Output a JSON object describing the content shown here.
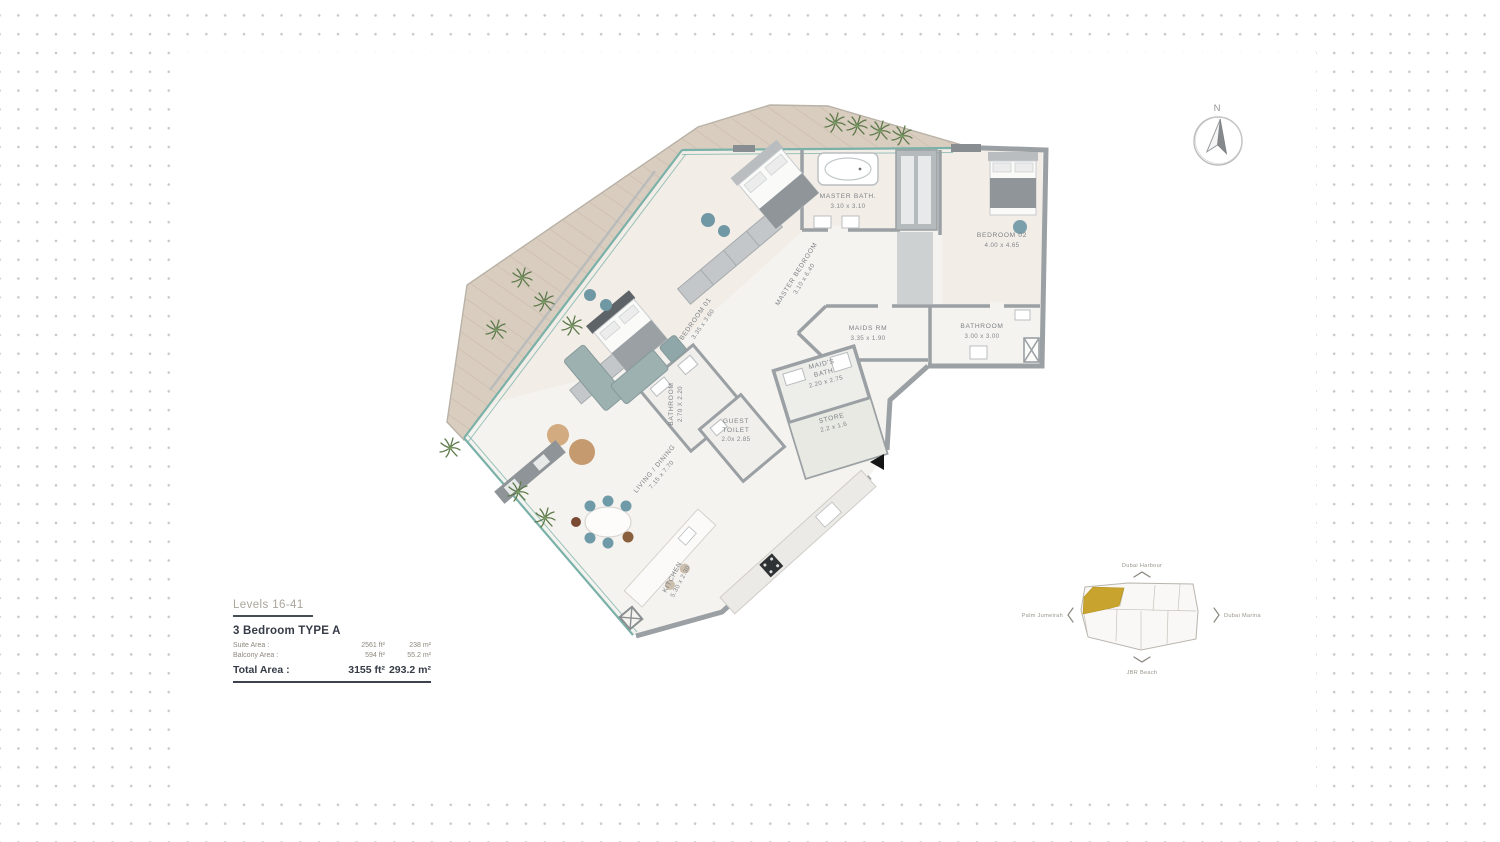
{
  "legend": {
    "levels": "Levels 16-41",
    "unit_type": "3 Bedroom  TYPE A",
    "rows": [
      {
        "label": "Suite Area :",
        "ft": "2561 ft²",
        "m": "238 m²"
      },
      {
        "label": "Balcony Area :",
        "ft": "594 ft²",
        "m": "55.2 m²"
      }
    ],
    "total": {
      "label": "Total Area :",
      "ft": "3155 ft²",
      "m": "293.2 m²"
    }
  },
  "compass": {
    "north_label": "N"
  },
  "rooms": [
    {
      "name": "MASTER BATH.",
      "dims": "3.10 x 3.10"
    },
    {
      "name": "MASTER BEDROOM",
      "dims": "3.10 x 6.40"
    },
    {
      "name": "BEDROOM 02",
      "dims": "4.00 x 4.65"
    },
    {
      "name": "BEDROOM 01",
      "dims": "3.35 x 3.60"
    },
    {
      "name": "MAIDS RM",
      "dims": "3.35 x 1.90"
    },
    {
      "name": "BATHROOM",
      "dims": "3.00 x 3.00"
    },
    {
      "name": "BATHROOM",
      "dims": "2.70 X 2.20"
    },
    {
      "name": "MAID'S BATH",
      "line1": "MAID'S",
      "line2": "BATH",
      "dims": "2.20 x 2.75"
    },
    {
      "name": "STORE",
      "dims": "2.2 x 1.6"
    },
    {
      "name": "GUEST TOILET",
      "line1": "GUEST",
      "line2": "TOILET",
      "dims": "2.0x 2.85"
    },
    {
      "name": "LIVING / DINING",
      "dims": "7.15 x 7.70"
    },
    {
      "name": "KITCHEN",
      "dims": "5.30 x 2.30"
    }
  ],
  "site_map": {
    "top": "Dubai Harbour",
    "right": "Dubai Marina",
    "bottom": "JBR Beach",
    "left": "Palm Jumeirah"
  },
  "colors": {
    "window_teal": "#7ab1a9",
    "deck_wood": "#d9cdc0",
    "wall_gray": "#9aa0a3",
    "map_highlight_gold": "#c8a42e",
    "legend_dark": "#3c424c",
    "dot_gray": "#c7c7c7"
  }
}
